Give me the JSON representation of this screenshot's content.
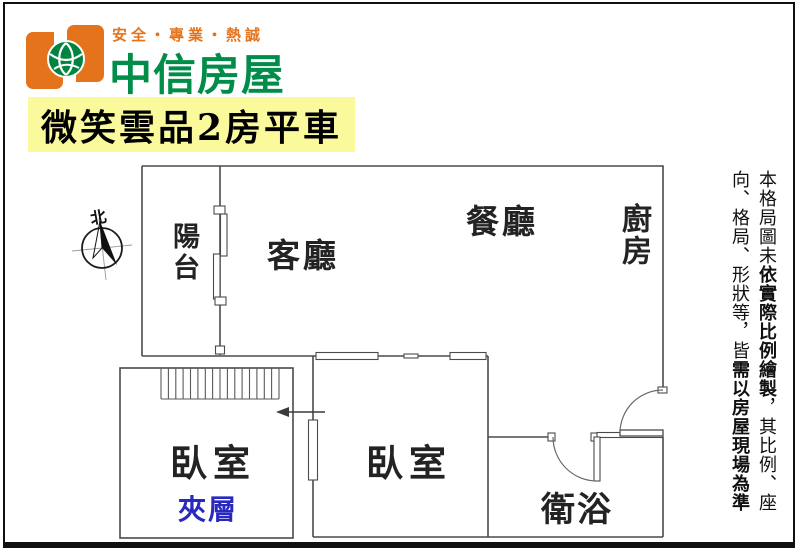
{
  "header": {
    "slogan": "安全・專業・熱誠",
    "brand": "中信房屋",
    "listing_title": "微笑雲品2房平車"
  },
  "plan": {
    "compass_north": "北",
    "rooms": {
      "balcony": "陽台",
      "living": "客廳",
      "dining": "餐廳",
      "kitchen": "廚房",
      "bedroom_left": "臥室",
      "bedroom_mid": "臥室",
      "bathroom": "衛浴",
      "mezzanine": "夾層"
    }
  },
  "disclaimer": {
    "column1": [
      {
        "text": "本格局圖未",
        "bold": false
      },
      {
        "text": "依實際比例繪製",
        "bold": true
      },
      {
        "text": "，其比例、座",
        "bold": false
      }
    ],
    "column2": [
      {
        "text": "向、格局、形狀等，皆",
        "bold": false
      },
      {
        "text": "需以房屋現場為準",
        "bold": true
      }
    ]
  },
  "colors": {
    "brand_green": "#008c49",
    "brand_orange": "#e4731c",
    "banner_yellow": "#fafa9c",
    "mezzanine_blue": "#2929c0",
    "wall_gray": "#4a4a4a"
  }
}
